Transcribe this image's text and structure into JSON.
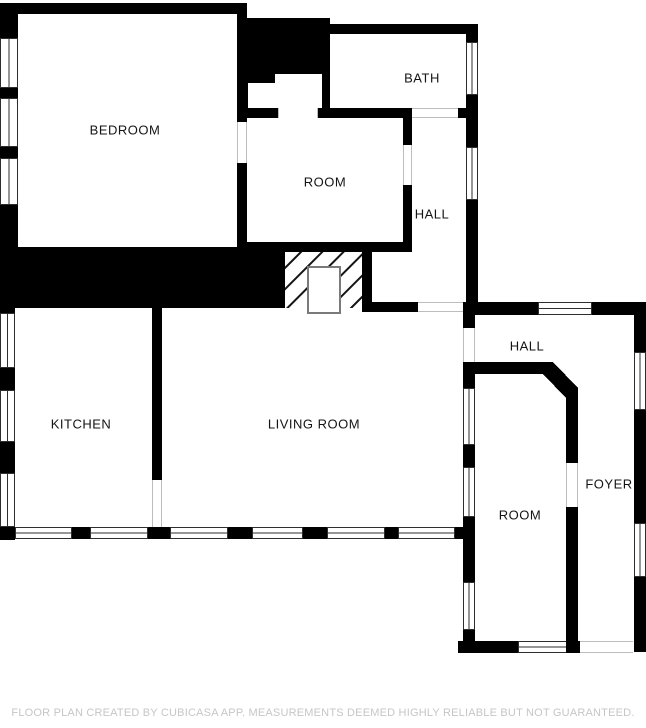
{
  "plan": {
    "rooms": {
      "bedroom": {
        "label": "BEDROOM"
      },
      "bath": {
        "label": "BATH"
      },
      "room_upper": {
        "label": "ROOM"
      },
      "hall_upper": {
        "label": "HALL"
      },
      "kitchen": {
        "label": "KITCHEN"
      },
      "living_room": {
        "label": "LIVING ROOM"
      },
      "hall_lower": {
        "label": "HALL"
      },
      "foyer": {
        "label": "FOYER"
      },
      "room_lower": {
        "label": "ROOM"
      }
    },
    "footer": "FLOOR PLAN CREATED BY CUBICASA APP. MEASUREMENTS DEEMED HIGHLY RELIABLE BUT NOT GUARANTEED.",
    "colors": {
      "wall": "#000000",
      "background": "#ffffff",
      "window_frame": "#2e2e2e",
      "footer_text": "#c6c6c6"
    }
  }
}
